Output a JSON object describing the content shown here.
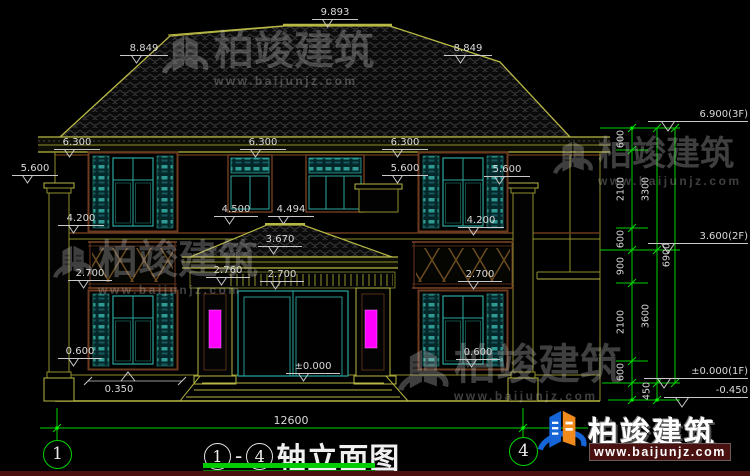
{
  "brand": {
    "name": "柏竣建筑",
    "url": "www.baijunjz.com"
  },
  "title": {
    "axis_start": "1",
    "separator": "-",
    "axis_end": "4",
    "text": "轴立面图"
  },
  "axis_bubbles": {
    "left": "1",
    "right": "4"
  },
  "dims": {
    "total_width": "12600",
    "offset": "0.350",
    "levels": {
      "ridge": "9.893",
      "gable_left": "8.849",
      "gable_right": "8.849",
      "eave_left": "6.300",
      "eave_center": "6.300",
      "eave_right": "6.300",
      "cap_left": "5.600",
      "cap_center": "5.600",
      "cap_right": "5.600",
      "sill2_left": "4.200",
      "sill2_right": "4.200",
      "porch_top_left": "4.500",
      "porch_top_right": "4.494",
      "porch_ridge": "3.670",
      "porch_eave": "2.760",
      "porch_beam": "2.700",
      "rail_left": "2.700",
      "rail_right": "2.700",
      "sill1_left": "0.600",
      "sill1_right": "0.600",
      "zero": "±0.000"
    },
    "floor_levels": {
      "f3": "6.900(3F)",
      "f2": "3.600(2F)",
      "f1": "±0.000(1F)",
      "ground": "-0.450"
    },
    "vertical_chain": {
      "segments": [
        "600",
        "2100",
        "600",
        "900",
        "2100",
        "600",
        "450"
      ],
      "floors": [
        "3300",
        "3600"
      ],
      "total": "6900"
    }
  },
  "colors": {
    "background": "#000000",
    "line_olive": "#b8b844",
    "line_green": "#00d400",
    "teal": "#2e9c94",
    "cyan_frame": "#2aa79e",
    "brown": "#6b3a1f",
    "magenta": "#ff00ff",
    "dim_text": "#d9d9d9",
    "brand_blue": "#1565d8",
    "brand_orange": "#f08a1d",
    "underline_green": "#00cc00",
    "maroon": "#4a1010"
  }
}
